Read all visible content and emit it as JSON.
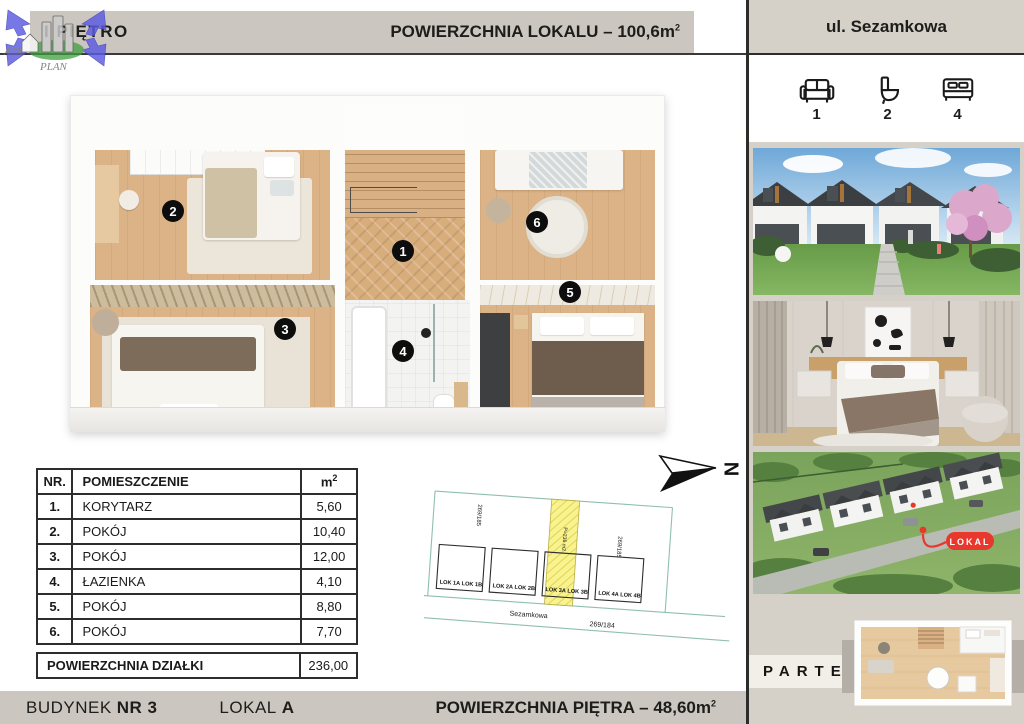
{
  "header": {
    "floor": "I PIĘTRO",
    "area_label": "POWIERZCHNIA LOKALU – 100,6m",
    "area_sup": "2",
    "street": "ul. Sezamkowa"
  },
  "watermark": {
    "ata": "ATA",
    "plan": "PLAN"
  },
  "stats": {
    "items": [
      {
        "icon": "sofa-icon",
        "count": "1"
      },
      {
        "icon": "toilet-icon",
        "count": "2"
      },
      {
        "icon": "bed-icon",
        "count": "4"
      }
    ]
  },
  "floorplan": {
    "badges": [
      {
        "n": "1"
      },
      {
        "n": "2"
      },
      {
        "n": "3"
      },
      {
        "n": "4"
      },
      {
        "n": "5"
      },
      {
        "n": "6"
      }
    ]
  },
  "room_table": {
    "col_nr": "NR.",
    "col_name": "POMIESZCZENIE",
    "col_area": "m",
    "col_area_sup": "2",
    "rows": [
      {
        "nr": "1.",
        "name": "KORYTARZ",
        "area": "5,60"
      },
      {
        "nr": "2.",
        "name": "POKÓJ",
        "area": "10,40"
      },
      {
        "nr": "3.",
        "name": "POKÓJ",
        "area": "12,00"
      },
      {
        "nr": "4.",
        "name": "ŁAZIENKA",
        "area": "4,10"
      },
      {
        "nr": "5.",
        "name": "POKÓJ",
        "area": "8,80"
      },
      {
        "nr": "6.",
        "name": "POKÓJ",
        "area": "7,70"
      }
    ],
    "total_label": "POWIERZCHNIA DZIAŁKI",
    "total_value": "236,00"
  },
  "site_plan": {
    "north": "N",
    "strip_label": "P=236 m2",
    "parcel_left": "269/185",
    "parcel_right": "269/185",
    "street": "Sezamkowa",
    "parcel_street": "269/184",
    "buildings": [
      {
        "a": "LOK 1A",
        "b": "LOK 1B"
      },
      {
        "a": "LOK 2A",
        "b": "LOK 2B"
      },
      {
        "a": "LOK 3A",
        "b": "LOK 3B"
      },
      {
        "a": "LOK 4A",
        "b": "LOK 4B"
      }
    ]
  },
  "sidebar": {
    "lokal_badge": "LOKAL",
    "parter": "PARTER"
  },
  "footer": {
    "building_label": "BUDYNEK",
    "building_no": "NR 3",
    "unit_label": "LOKAL",
    "unit_no": "A",
    "floor_area_label": "POWIERZCHNIA PIĘTRA – 48,60m",
    "floor_area_sup": "2"
  },
  "colors": {
    "accent_red": "#E8372C",
    "header_gray": "#CBC7C0",
    "sidebar_beige": "#D6D1C8",
    "highlight_yellow": "#F7F28C",
    "map_line_teal": "#8FC0AB"
  }
}
